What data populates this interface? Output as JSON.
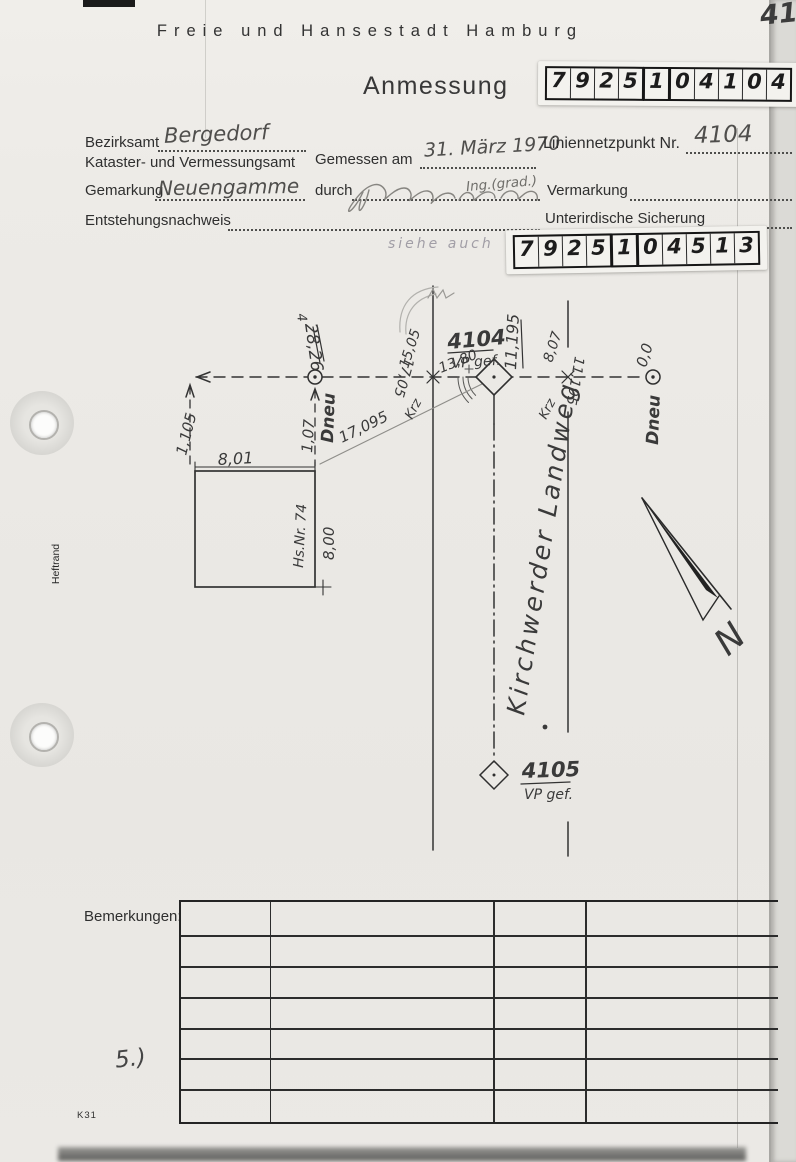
{
  "doc": {
    "corner_note": "416",
    "header": "Freie und Hansestadt Hamburg",
    "title": "Anmessung",
    "code_top": [
      "7",
      "9",
      "2",
      "5",
      "1",
      "0",
      "4",
      "1",
      "0",
      "4"
    ],
    "code_bottom": [
      "7",
      "9",
      "2",
      "5",
      "1",
      "0",
      "4",
      "5",
      "1",
      "3"
    ],
    "see_also": "siehe auch",
    "labels": {
      "bezirksamt": "Bezirksamt",
      "amt": "Kataster- und Vermessungsamt",
      "gemessen": "Gemessen am",
      "liniennetzpunkt": "Liniennetzpunkt Nr.",
      "gemarkung": "Gemarkung",
      "durch": "durch",
      "vermarkung": "Vermarkung",
      "entstehung": "Entstehungsnachweis",
      "sicherung": "Unterirdische Sicherung"
    },
    "values": {
      "bezirksamt": "Bergedorf",
      "gemessen": "31. März 1970",
      "liniennetzpunkt": "4104",
      "gemarkung": "Neuengamme",
      "durch": "Ing.(grad.)"
    },
    "sketch": {
      "point_main": "4104",
      "point_main_sub": "VP gef.",
      "point_south": "4105",
      "point_south_sub": "VP gef.",
      "street": "Kirchwerder Landweg",
      "dneu_left": "Dneu",
      "dneu_right": "Dneu",
      "house_no": "Hs.Nr. 74",
      "m_801": "8,01",
      "m_800": "8,00",
      "m_1105": "1,105",
      "m_107": "1,07",
      "m_2826": "28,26",
      "m_4": "4",
      "m_17095": "17,095",
      "m_1505": "15,05",
      "m_1705": "17,05",
      "m_1380": "13,80",
      "m_11195_a": "11,195",
      "m_11195_b": "11,195",
      "m_807": "8,07",
      "m_00": "0,0",
      "krz_left": "Krz",
      "krz_right": "Krz",
      "north": "N"
    },
    "bemerkungen_label": "Bemerkungen:",
    "note5": "5.)",
    "form_code": "K31",
    "heftrand": "Heftrand"
  }
}
